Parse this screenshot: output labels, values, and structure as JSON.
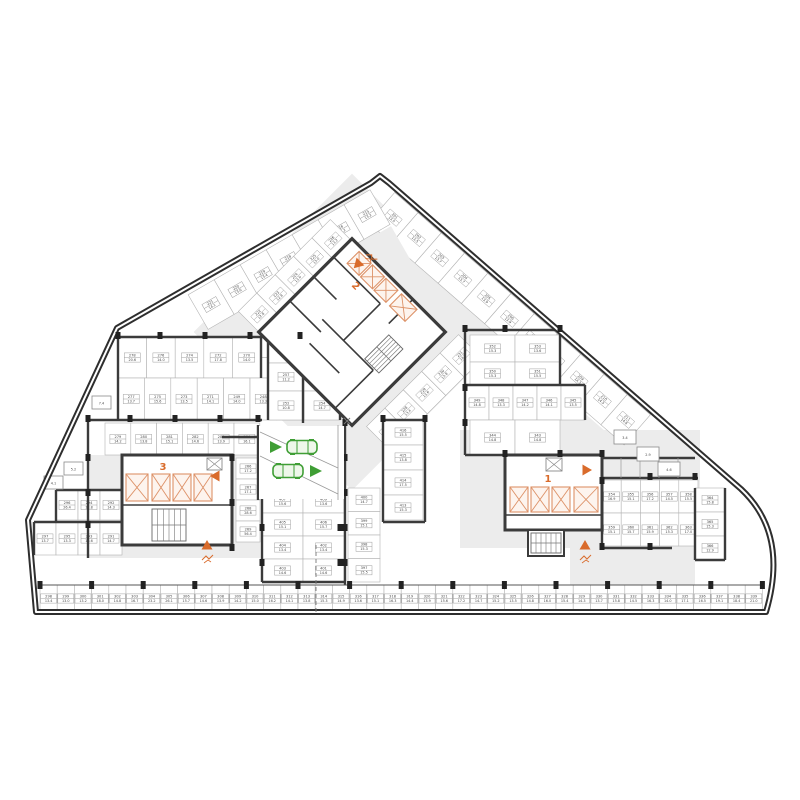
{
  "plan": {
    "type": "parking-level-floor-plan",
    "colors": {
      "wall": "#3b3b3b",
      "aisle": "#ececec",
      "accent_orange": "#d96b2b",
      "accent_green": "#3f9e35",
      "label_border": "#949494"
    },
    "cores": {
      "c1": "1",
      "c2": "2",
      "c3": "3"
    },
    "icons": [
      "car-icon",
      "entry-arrow-icon",
      "exit-arrow-icon",
      "ramp-triangle-icon",
      "ramp-slope-icon",
      "elevator-icon",
      "stairs-icon",
      "vent-shaft-icon"
    ],
    "zones": {
      "bottom_row": [
        [
          "298",
          "13.4"
        ],
        [
          "299",
          "13.0"
        ],
        [
          "300",
          "13.2"
        ],
        [
          "301",
          "18.0"
        ],
        [
          "302",
          "14.8"
        ],
        [
          "303",
          "16.7"
        ],
        [
          "304",
          "23.2"
        ],
        [
          "305",
          "26.1"
        ],
        [
          "306",
          "15.7"
        ],
        [
          "307",
          "14.6"
        ],
        [
          "308",
          "13.9"
        ],
        [
          "309",
          "14.2"
        ],
        [
          "310",
          "15.0"
        ],
        [
          "311",
          "16.2"
        ],
        [
          "312",
          "14.1"
        ],
        [
          "313",
          "13.8"
        ],
        [
          "314",
          "15.3"
        ],
        [
          "315",
          "14.9"
        ],
        [
          "316",
          "13.6"
        ],
        [
          "317",
          "15.1"
        ],
        [
          "318",
          "16.3"
        ],
        [
          "319",
          "14.4"
        ],
        [
          "320",
          "13.9"
        ],
        [
          "321",
          "15.6"
        ],
        [
          "322",
          "17.2"
        ],
        [
          "323",
          "14.7"
        ],
        [
          "324",
          "15.2"
        ],
        [
          "325",
          "13.5"
        ],
        [
          "326",
          "14.8"
        ],
        [
          "327",
          "16.0"
        ],
        [
          "328",
          "15.4"
        ],
        [
          "329",
          "14.3"
        ],
        [
          "330",
          "13.7"
        ],
        [
          "331",
          "15.8"
        ],
        [
          "332",
          "14.5"
        ],
        [
          "333",
          "16.3"
        ],
        [
          "334",
          "14.0"
        ],
        [
          "335",
          "17.1"
        ],
        [
          "336",
          "16.5"
        ],
        [
          "337",
          "19.1"
        ],
        [
          "338",
          "18.4"
        ],
        [
          "339",
          "21.0"
        ]
      ],
      "left_row_a": [
        [
          "278",
          "20.6"
        ],
        [
          "276",
          "14.0"
        ],
        [
          "274",
          "13.5"
        ],
        [
          "272",
          "17.8"
        ],
        [
          "270",
          "14.0"
        ]
      ],
      "left_pair": [
        [
          "246",
          "15.8"
        ],
        [
          "245",
          "16.3"
        ]
      ],
      "left_row_b": [
        [
          "277",
          "13.7"
        ],
        [
          "275",
          "15.6"
        ],
        [
          "273",
          "13.5"
        ],
        [
          "271",
          "14.1"
        ],
        [
          "249",
          "14.0"
        ],
        [
          "248",
          "13.3"
        ],
        [
          "247",
          "15.5"
        ]
      ],
      "left_mid_row": [
        [
          "279",
          "14.2"
        ],
        [
          "280",
          "13.8"
        ],
        [
          "281",
          "15.1"
        ],
        [
          "282",
          "14.6"
        ],
        [
          "283",
          "13.9"
        ],
        [
          "284",
          "16.1"
        ]
      ],
      "left_col": [
        [
          "266",
          "17.2"
        ],
        [
          "267",
          "17.1"
        ],
        [
          "268",
          "28.6"
        ],
        [
          "269",
          "56.4"
        ]
      ],
      "left_low_a": [
        [
          "296",
          "26.4"
        ],
        [
          "294",
          "18.8"
        ],
        [
          "292",
          "14.3"
        ]
      ],
      "left_low_b": [
        [
          "297",
          "13.7"
        ],
        [
          "295",
          "13.3"
        ],
        [
          "293",
          "16.6"
        ],
        [
          "291",
          "14.7"
        ]
      ],
      "center_r1": [
        [
          "259",
          "10.3"
        ],
        [
          "258",
          "13.6"
        ]
      ],
      "center_r2": [
        [
          "257",
          "11.2"
        ],
        [
          "256",
          "13.8"
        ]
      ],
      "center_r3": [
        [
          "252",
          "10.8"
        ],
        [
          "254",
          "14.7"
        ]
      ],
      "cb_r1": [
        [
          "407",
          "15.6"
        ],
        [
          "409",
          "13.6"
        ]
      ],
      "cb_r2": [
        [
          "405",
          "15.1"
        ],
        [
          "406",
          "15.7"
        ]
      ],
      "cb_r3": [
        [
          "404",
          "13.4"
        ],
        [
          "402",
          "13.4"
        ]
      ],
      "cb_r4": [
        [
          "403",
          "14.6"
        ],
        [
          "401",
          "14.6"
        ]
      ],
      "center_right_col": [
        [
          "400",
          "14.7"
        ],
        [
          "399",
          "15.1"
        ],
        [
          "398",
          "15.3"
        ],
        [
          "397",
          "15.5"
        ]
      ],
      "entr_right_col": [
        [
          "416",
          "15.5"
        ],
        [
          "415",
          "13.8"
        ],
        [
          "414",
          "17.5"
        ],
        [
          "413",
          "15.3"
        ]
      ],
      "right_pair_a": [
        [
          "352",
          "15.3"
        ],
        [
          "353",
          "13.6"
        ]
      ],
      "right_pair_b": [
        [
          "350",
          "15.3"
        ],
        [
          "351",
          "15.5"
        ]
      ],
      "right_row5": [
        [
          "349",
          "14.8"
        ],
        [
          "348",
          "13.3"
        ],
        [
          "347",
          "14.2"
        ],
        [
          "346",
          "14.1"
        ],
        [
          "345",
          "13.5"
        ]
      ],
      "right_pair_c": [
        [
          "344",
          "14.8"
        ],
        [
          "343",
          "14.8"
        ]
      ],
      "rc_r1": [
        [
          "354",
          "16.9"
        ],
        [
          "355",
          "15.1"
        ],
        [
          "356",
          "17.2"
        ],
        [
          "357",
          "14.5"
        ],
        [
          "358",
          "15.5"
        ]
      ],
      "rc_r2": [
        [
          "359",
          "15.1"
        ],
        [
          "360",
          "15.7"
        ],
        [
          "361",
          "15.9"
        ],
        [
          "362",
          "15.3"
        ],
        [
          "363",
          "17.0"
        ]
      ],
      "corner_col": [
        [
          "364",
          "15.8"
        ],
        [
          "365",
          "15.3"
        ],
        [
          "366",
          "12.9"
        ]
      ],
      "band_right_edge": [
        [
          "201",
          "13.5"
        ],
        [
          "202",
          "13.5"
        ],
        [
          "203",
          "13.7"
        ],
        [
          "204",
          "13.7"
        ],
        [
          "205",
          "13.9"
        ],
        [
          "206",
          "13.9"
        ],
        [
          "207",
          "14.1"
        ],
        [
          "208",
          "14.1"
        ],
        [
          "209",
          "14.3"
        ],
        [
          "210",
          "14.5"
        ],
        [
          "211",
          "14.8"
        ]
      ],
      "band_left_edge": [
        [
          "215",
          "13.2"
        ],
        [
          "216",
          "13.2"
        ],
        [
          "217",
          "13.2"
        ],
        [
          "218",
          "13.4"
        ],
        [
          "219",
          "13.4"
        ],
        [
          "220",
          "13.6"
        ],
        [
          "221",
          "14.1"
        ]
      ],
      "band_core_nw": [
        [
          "222",
          "12.8"
        ],
        [
          "223",
          "12.8"
        ],
        [
          "224",
          "13.0"
        ],
        [
          "225",
          "13.0"
        ],
        [
          "226",
          "13.2"
        ]
      ],
      "band_core_se": [
        [
          "227",
          "13.4"
        ],
        [
          "228",
          "13.4"
        ],
        [
          "229",
          "13.6"
        ],
        [
          "230",
          "13.8"
        ],
        [
          "231",
          "14.0"
        ]
      ],
      "utility_left": [
        "7.4",
        "5.2",
        "4.1"
      ],
      "utility_right": [
        "3.4",
        "2.9",
        "4.6"
      ]
    }
  }
}
